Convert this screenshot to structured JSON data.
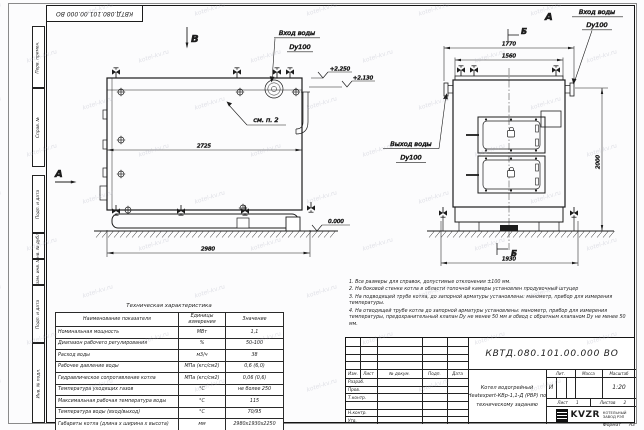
{
  "watermark": "kotel-kv.ru",
  "frame": {
    "strips": [
      "Перв. примен.",
      "Справ. №",
      "Подп. и дата",
      "Инв. № дубл.",
      "Взам. инв. №",
      "Подп. и дата",
      "Инв. № подл."
    ]
  },
  "drawing": {
    "view_b_label": "В",
    "view_a_label": "А",
    "view_a_top": "А",
    "section_b_top": "Б",
    "section_b_bottom": "Б",
    "see_note": "см. п. 2",
    "inlet_left_line1": "Вход воды",
    "inlet_left_line2": "Dy100",
    "inlet_right_line1": "Вход воды",
    "inlet_right_line2": "Dy100",
    "outlet_line1": "Выход воды",
    "outlet_line2": "Dy100",
    "dim_2725": "2725",
    "dim_2980": "2980",
    "dim_1770": "1770",
    "dim_1560": "1560",
    "dim_2000": "2000",
    "dim_1930": "1930",
    "elev_top": "+2.250",
    "elev_mid": "+2.130",
    "elev_ground": "0.000"
  },
  "tech_table": {
    "title": "Техническая характеристика",
    "headers": [
      "Наименование показателя",
      "Единицы измерения",
      "Значение"
    ],
    "rows": [
      [
        "Номинальная мощность",
        "МВт",
        "1,1"
      ],
      [
        "Диапазон рабочего регулирования",
        "%",
        "50-100"
      ],
      [
        "Расход воды",
        "м3/ч",
        "38"
      ],
      [
        "Рабочее давление воды",
        "МПа (кгс/см2)",
        "0,6 (6,0)"
      ],
      [
        "Гидравлическое сопротивление котла",
        "МПа (кгс/см2)",
        "0,06 (0,6)"
      ],
      [
        "Температура уходящих газов",
        "°С",
        "не более 250"
      ],
      [
        "Максимальная рабочая температура воды",
        "°С",
        "115"
      ],
      [
        "Температура воды (вход/выход)",
        "°С",
        "70/95"
      ],
      [
        "Габариты котла (длина х ширина х высота)",
        "мм",
        "2980х1930х2250"
      ]
    ]
  },
  "notes": [
    "1. Все размеры для справок, допустимые отклонения ±100 мм.",
    "2. На боковой стенке котла в области топочной камеры установлен продувочный штуцер",
    "3. На подводящей трубе котла, до запорной арматуры установлены: манометр, прибор для измерения температуры.",
    "4. На отводящей трубе котла до запорной арматуры установлены: манометр, прибор для измерения температуры, предохранительный клапан Dу не менее 50 мм и обвод с обратным клапаном Dу не менее 50 мм."
  ],
  "title_block": {
    "designation": "КВТД.080.101.00.000 ВО",
    "name_line1": "Котел водогрейный",
    "name_line2": "Heatexpert-КВр-1,1-Д (РВР) по",
    "name_line3": "техническому заданию",
    "col_izm": "Изм.",
    "col_list": "Лист",
    "col_ndoc": "№ докум.",
    "col_podp": "Подп.",
    "col_data": "Дата",
    "row_razrab": "Разраб.",
    "row_prov": "Пров.",
    "row_tkontr": "Т.контр.",
    "row_nkontr": "Н.контр.",
    "row_utv": "Утв.",
    "lit_label": "Лит.",
    "lit_value": "И",
    "mass_label": "Масса",
    "scale_label": "Масштаб",
    "scale_value": "1:20",
    "sheet_label": "Лист",
    "sheet_value": "1",
    "sheets_label": "Листов",
    "sheets_value": "2",
    "logo_text": "KVZR",
    "logo_caption1": "КОТЕЛЬНЫЙ",
    "logo_caption2": "ЗАВОД РЭП",
    "format_label": "Формат",
    "format_value": "А3"
  }
}
